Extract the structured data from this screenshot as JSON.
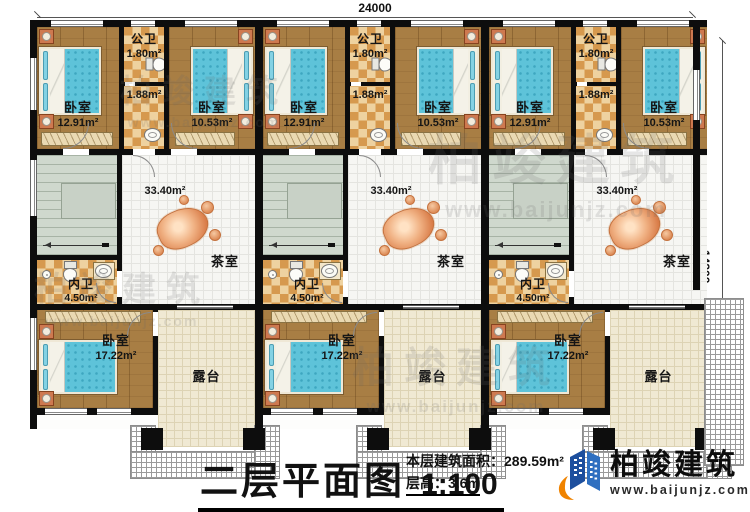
{
  "drawing": {
    "dim_top": "24000",
    "dim_right": "14300",
    "title": "二层平面图",
    "scale": "1:100",
    "area_line": "本层建筑面积：289.59m²",
    "height_line": "层高：3.6m"
  },
  "brand": {
    "name": "柏竣建筑",
    "website": "www.baijunjz.com",
    "logo_blue": "#1d4f9e",
    "logo_light_blue": "#2e6fc0",
    "logo_orange": "#f08300"
  },
  "watermark": {
    "name": "柏竣建筑",
    "website": "www.baijunjz.com"
  },
  "units": [
    {
      "bedroom_top_left": {
        "label": "卧室",
        "area": "12.91m²"
      },
      "public_bath": {
        "label": "公卫",
        "area": "1.80m²",
        "area2": "1.88m²"
      },
      "bedroom_top_right": {
        "label": "卧室",
        "area": "10.53m²"
      },
      "stairs": {
        "down": "下"
      },
      "tea_room": {
        "label": "茶室",
        "area": "33.40m²"
      },
      "inner_bath": {
        "label": "内卫",
        "area": "4.50m²"
      },
      "bedroom_bottom": {
        "label": "卧室",
        "area": "17.22m²"
      },
      "terrace": {
        "label": "露台"
      }
    },
    {
      "bedroom_top_left": {
        "label": "卧室",
        "area": "12.91m²"
      },
      "public_bath": {
        "label": "公卫",
        "area": "1.80m²",
        "area2": "1.88m²"
      },
      "bedroom_top_right": {
        "label": "卧室",
        "area": "10.53m²"
      },
      "stairs": {
        "down": "下"
      },
      "tea_room": {
        "label": "茶室",
        "area": "33.40m²"
      },
      "inner_bath": {
        "label": "内卫",
        "area": "4.50m²"
      },
      "bedroom_bottom": {
        "label": "卧室",
        "area": "17.22m²"
      },
      "terrace": {
        "label": "露台"
      }
    },
    {
      "bedroom_top_left": {
        "label": "卧室",
        "area": "12.91m²"
      },
      "public_bath": {
        "label": "公卫",
        "area": "1.80m²",
        "area2": "1.88m²"
      },
      "bedroom_top_right": {
        "label": "卧室",
        "area": "10.53m²"
      },
      "stairs": {
        "down": "下"
      },
      "tea_room": {
        "label": "茶室",
        "area": "33.40m²"
      },
      "inner_bath": {
        "label": "内卫",
        "area": "4.50m²"
      },
      "bedroom_bottom": {
        "label": "卧室",
        "area": "17.22m²"
      },
      "terrace": {
        "label": "露台"
      }
    }
  ]
}
